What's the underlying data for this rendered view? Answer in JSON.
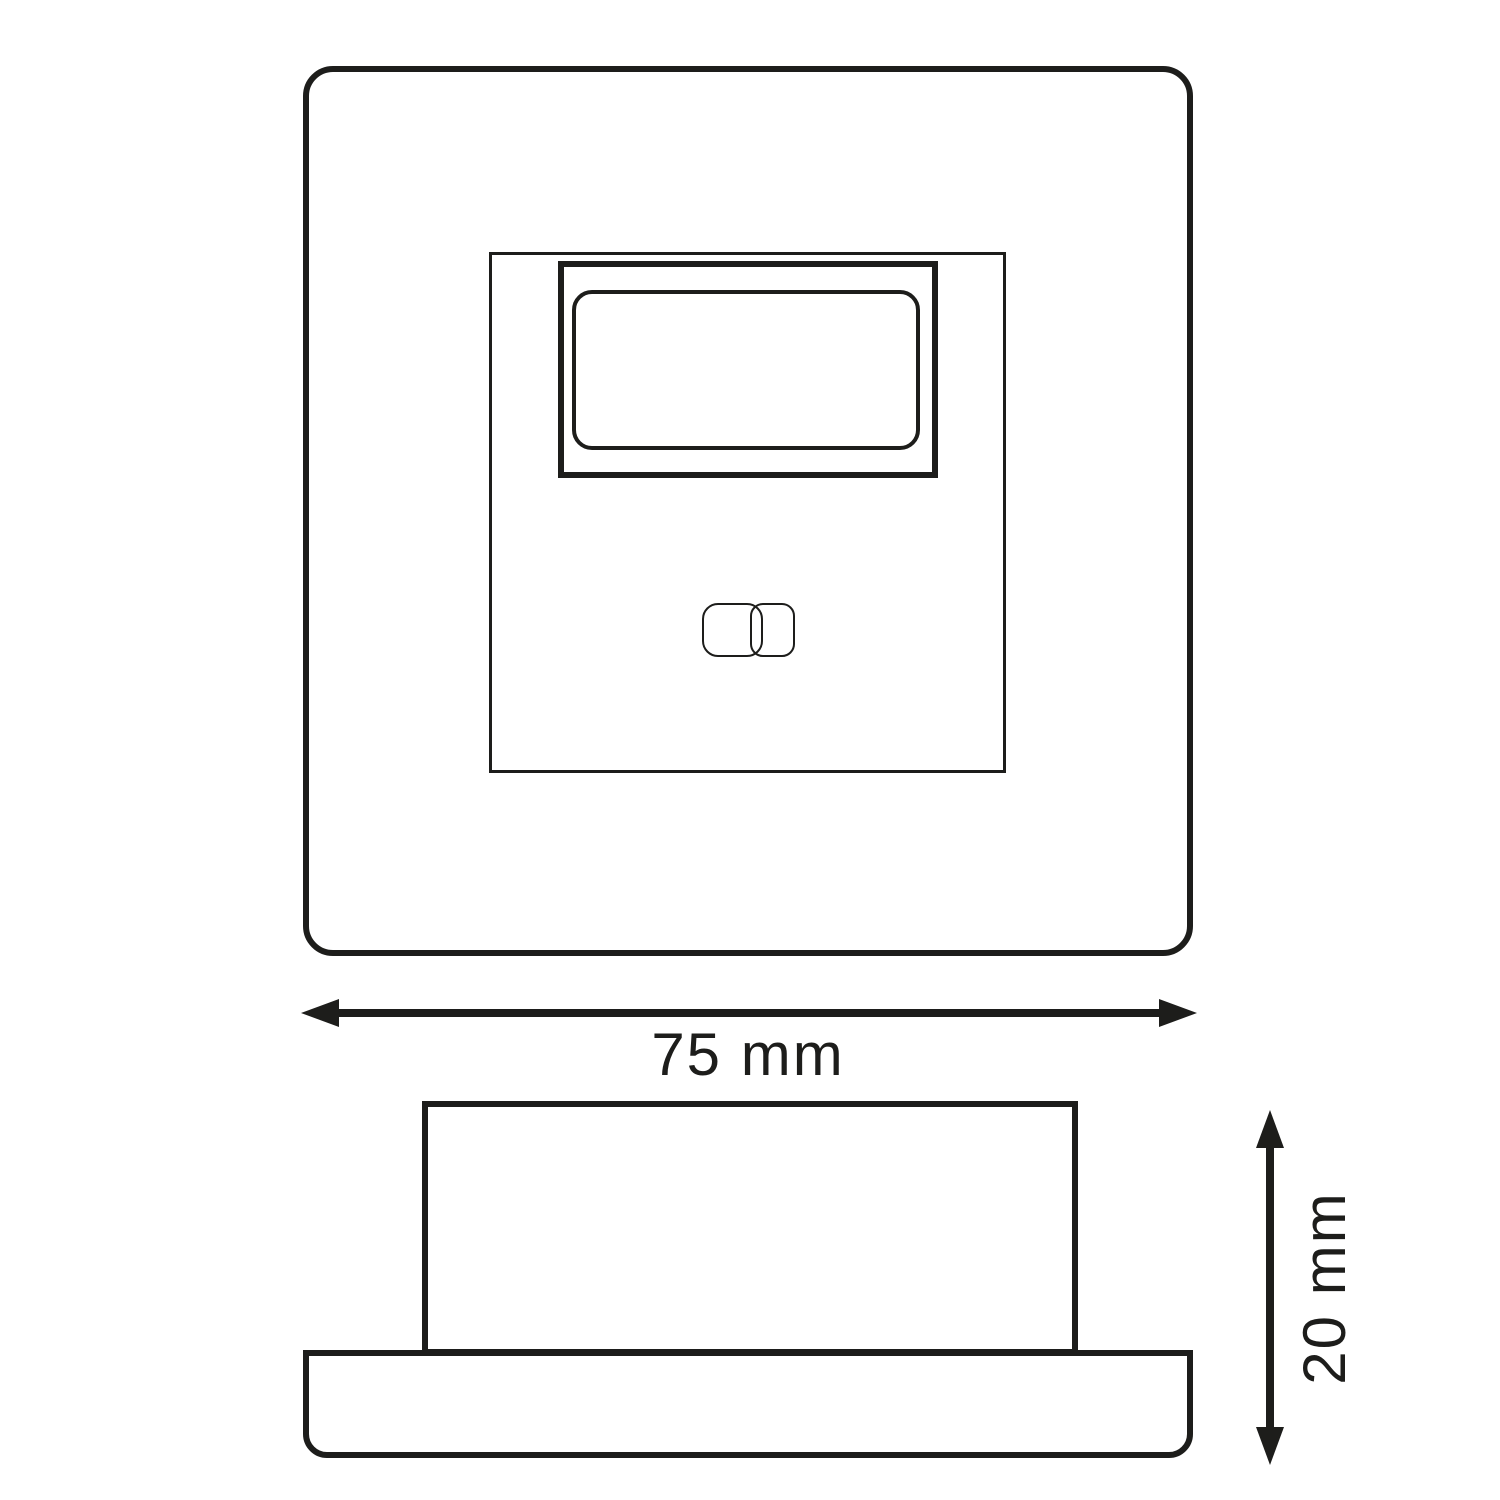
{
  "canvas": {
    "background": "#ffffff",
    "line_color": "#1d1d1b"
  },
  "diagram": {
    "type": "technical-drawing",
    "subject": "wall plate device with display window and toggle switch",
    "views": {
      "front": {
        "name": "front view"
      },
      "side": {
        "name": "side view"
      }
    },
    "dimensions": {
      "width": {
        "label": "75 mm",
        "value": 75,
        "unit": "mm"
      },
      "depth": {
        "label": "20 mm",
        "value": 20,
        "unit": "mm"
      }
    }
  }
}
